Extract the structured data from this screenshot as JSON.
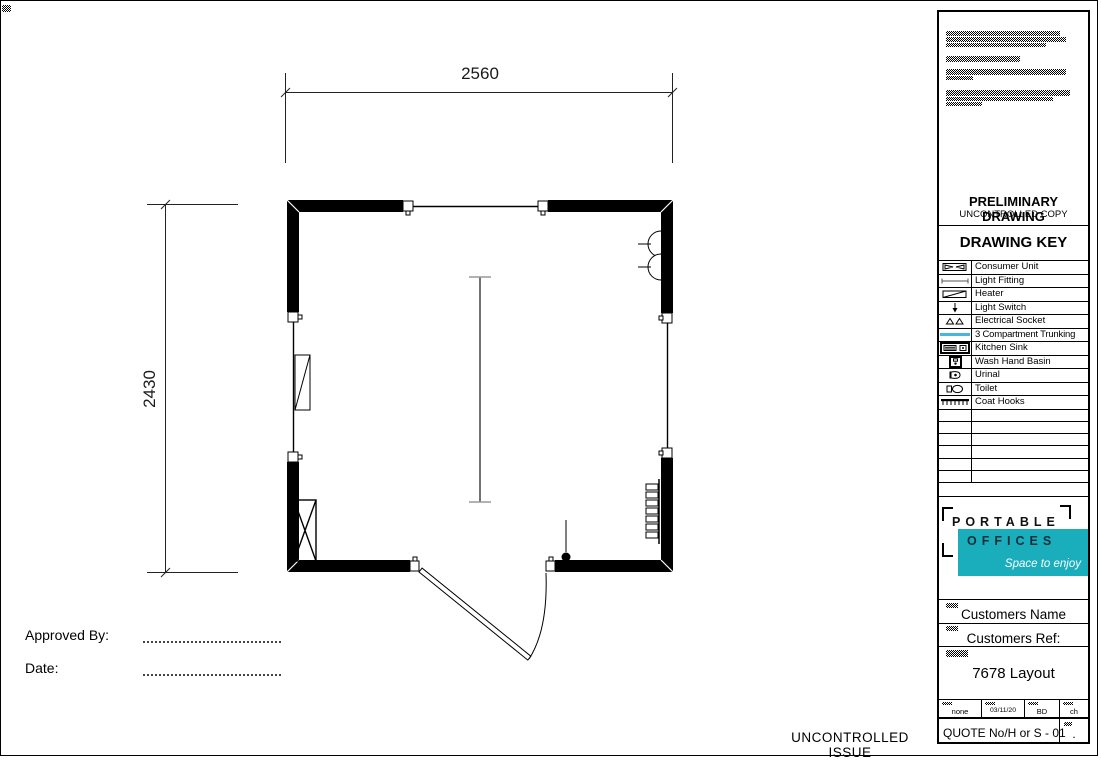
{
  "drawing": {
    "dimensions": {
      "width_mm": "2560",
      "height_mm": "2430"
    },
    "approval": {
      "approved_by_label": "Approved By:",
      "date_label": "Date:"
    },
    "footer_stamp": "UNCONTROLLED ISSUE"
  },
  "title_block": {
    "preliminary_title": "PRELIMINARY DRAWING",
    "preliminary_subtitle": "UNCONTROLLED COPY",
    "key_title": "DRAWING KEY",
    "key_items": [
      {
        "icon": "consumer-unit-icon",
        "label": "Consumer Unit"
      },
      {
        "icon": "light-fitting-icon",
        "label": "Light Fitting"
      },
      {
        "icon": "heater-icon",
        "label": "Heater"
      },
      {
        "icon": "light-switch-icon",
        "label": "Light Switch"
      },
      {
        "icon": "electrical-socket-icon",
        "label": "Electrical Socket"
      },
      {
        "icon": "trunking-icon",
        "label": "3 Compartment Trunking"
      },
      {
        "icon": "kitchen-sink-icon",
        "label": "Kitchen Sink"
      },
      {
        "icon": "wash-hand-basin-icon",
        "label": "Wash Hand Basin"
      },
      {
        "icon": "urinal-icon",
        "label": "Urinal"
      },
      {
        "icon": "toilet-icon",
        "label": "Toilet"
      },
      {
        "icon": "coat-hooks-icon",
        "label": "Coat Hooks"
      }
    ],
    "logo": {
      "name_line1": "PORTABLE",
      "name_line2": "OFFICES",
      "tagline": "Space to enjoy"
    },
    "customers_name_label": "Customers Name",
    "customers_ref_label": "Customers Ref:",
    "drawing_title": "7678 Layout",
    "meta_cells": [
      "none",
      "03/11/20",
      "BD",
      "ch"
    ],
    "quote_ref": "QUOTE No/H or S - 01",
    "quote_cell_value": "."
  },
  "colors": {
    "trunking_cyan": "#45B6DC",
    "logo_teal": "#1AAEBD"
  }
}
